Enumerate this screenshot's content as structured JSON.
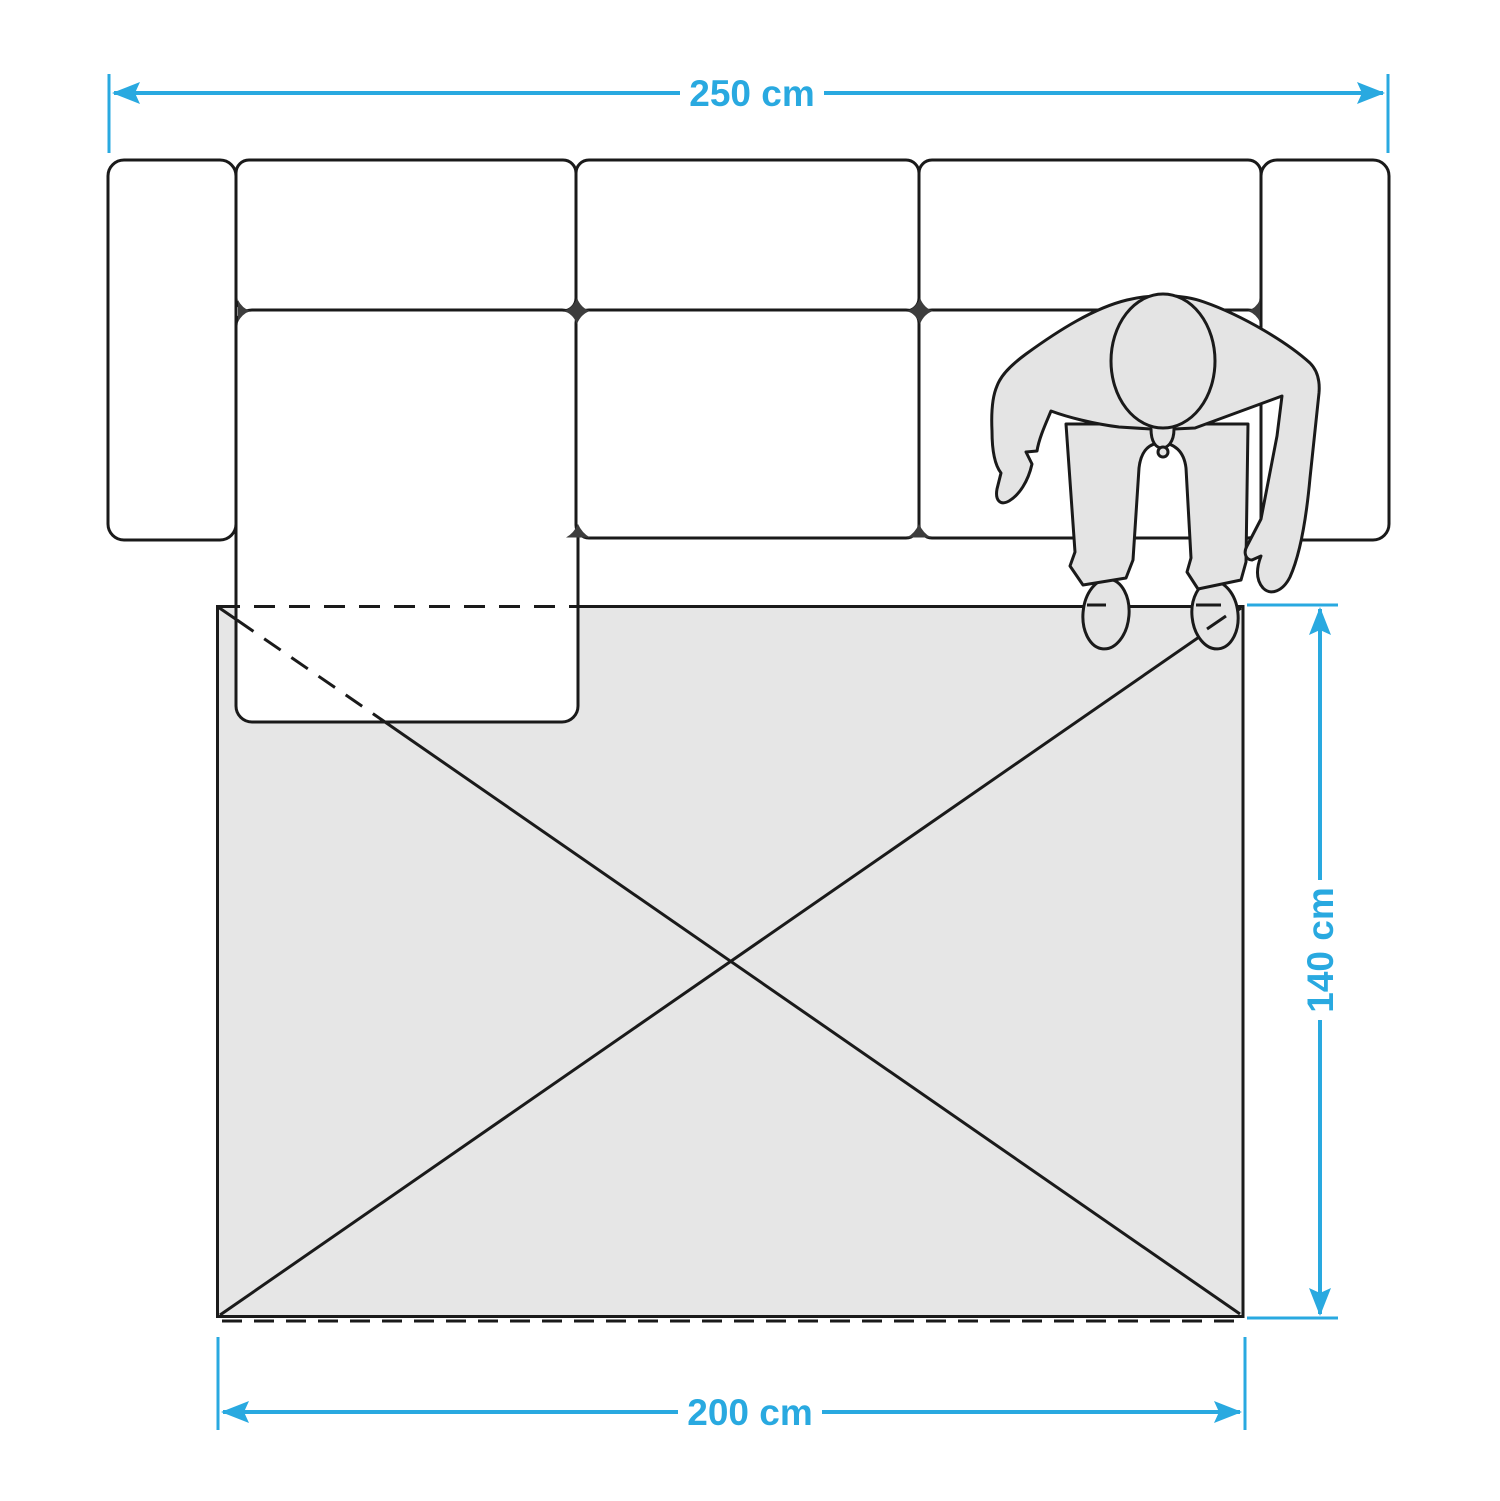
{
  "diagram": {
    "title": "rug-size-guide-top-view",
    "labels": {
      "sofa_width": "250 cm",
      "rug_length": "140 cm",
      "rug_width": "200 cm"
    },
    "colors": {
      "dimension": "#29A9E0",
      "outline": "#1A1A1A",
      "rug_fill": "#E6E6E6",
      "figure_fill": "#E4E4E4",
      "cushion_fill": "#FFFFFF",
      "gap_filler": "#3D3D3D",
      "background": "#FFFFFF"
    },
    "objects": {
      "sofa": {
        "back_cushions": 3,
        "seat_cushions": 3,
        "armrests": 2,
        "chaise_section": true
      },
      "rug": {
        "width_label": "200 cm",
        "length_label": "140 cm"
      },
      "person": "top-view figure standing at rug corner"
    }
  }
}
